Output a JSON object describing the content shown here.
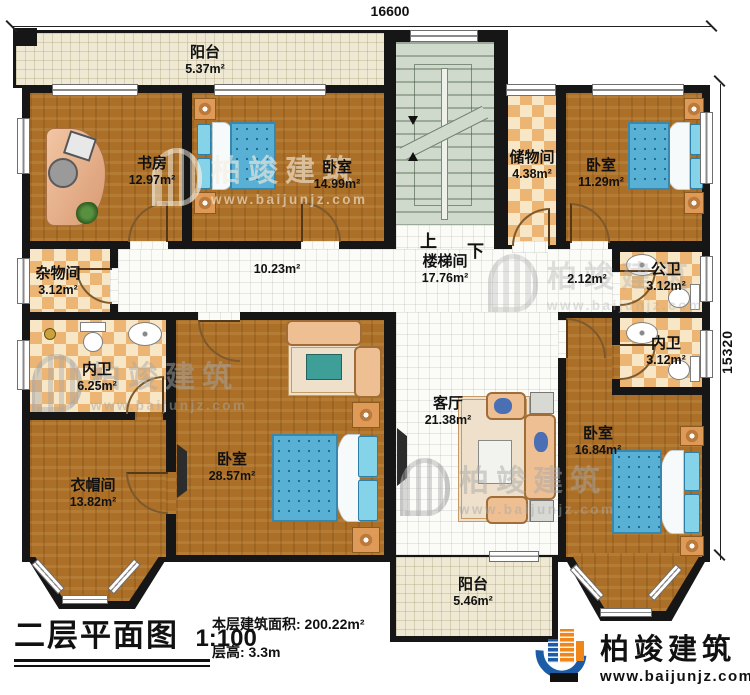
{
  "plan": {
    "dimensions": {
      "width": "16600",
      "height": "15320"
    },
    "stairs": {
      "up": "上",
      "down": "下"
    },
    "rooms": {
      "balcony_top": {
        "name": "阳台",
        "area": "5.37m²"
      },
      "study": {
        "name": "书房",
        "area": "12.97m²"
      },
      "bedroom_n": {
        "name": "卧室",
        "area": "14.99m²"
      },
      "storage": {
        "name": "储物间",
        "area": "4.38m²"
      },
      "bedroom_ne": {
        "name": "卧室",
        "area": "11.29m²"
      },
      "sundry": {
        "name": "杂物间",
        "area": "3.12m²"
      },
      "hallway": {
        "area": "10.23m²"
      },
      "stairwell": {
        "name": "楼梯间",
        "area": "17.76m²"
      },
      "hallway_e": {
        "area": "2.12m²"
      },
      "public_bath": {
        "name": "公卫",
        "area": "3.12m²"
      },
      "ensuite_e": {
        "name": "内卫",
        "area": "3.12m²"
      },
      "ensuite_w": {
        "name": "内卫",
        "area": "6.25m²"
      },
      "cloakroom": {
        "name": "衣帽间",
        "area": "13.82m²"
      },
      "bedroom_master": {
        "name": "卧室",
        "area": "28.57m²"
      },
      "living": {
        "name": "客厅",
        "area": "21.38m²"
      },
      "bedroom_se": {
        "name": "卧室",
        "area": "16.84m²"
      },
      "balcony_bottom": {
        "name": "阳台",
        "area": "5.46m²"
      }
    }
  },
  "title_block": {
    "title": "二层平面图",
    "scale": "1:100",
    "floor_area": "本层建筑面积: 200.22m²",
    "floor_height": "层高: 3.3m"
  },
  "brand": {
    "name": "柏竣建筑",
    "website": "www.baijunjz.com"
  },
  "watermark": {
    "name": "柏竣建筑",
    "website": "www.baijunjz.com"
  },
  "colors": {
    "wall": "#161616",
    "wood": "#ab6f27",
    "checker": "#ecb573",
    "bed_blue": "#58b1d5",
    "brand_blue": "#1c5ca6",
    "brand_orange": "#f08519"
  }
}
